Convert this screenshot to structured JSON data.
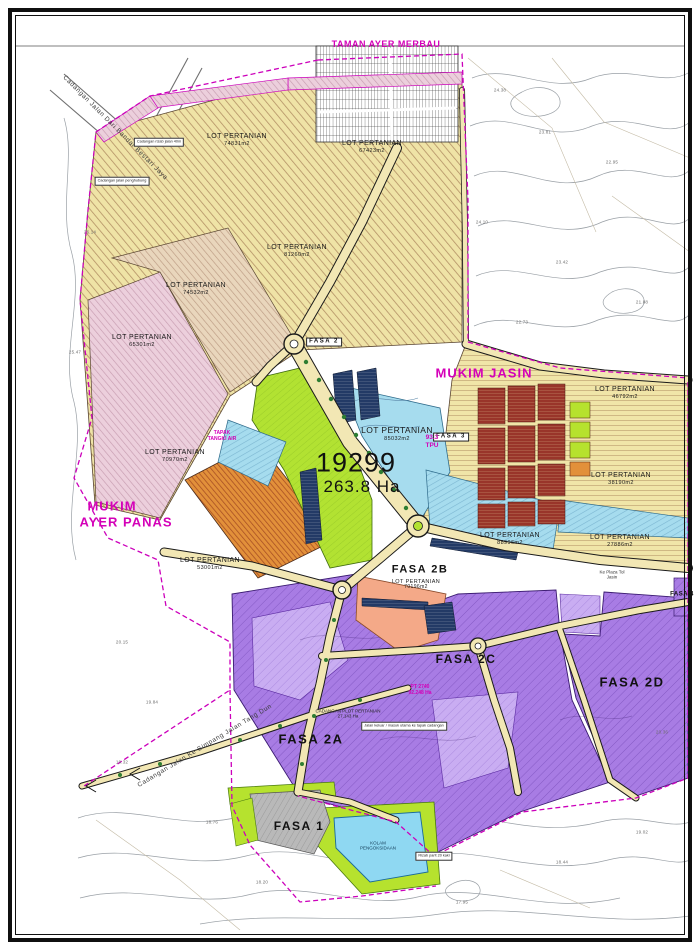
{
  "document": {
    "type": "site-layout-plan"
  },
  "region_labels": {
    "taman_ayer_merbau": "TAMAN AYER MERBAU",
    "mukim_jasin": "MUKIM JASIN",
    "mukim_line1": "MUKIM",
    "mukim_line2": "AYER PANAS"
  },
  "main_parcel": {
    "lot_no": "19299",
    "area": "263.8 Ha"
  },
  "lots": [
    {
      "name": "LOT PERTANIAN",
      "area": "74831m2"
    },
    {
      "name": "LOT PERTANIAN",
      "area": "67423m2"
    },
    {
      "name": "LOT PERTANIAN",
      "area": "81260m2"
    },
    {
      "name": "LOT PERTANIAN",
      "area": "74532m2"
    },
    {
      "name": "LOT PERTANIAN",
      "area": "65301m2"
    },
    {
      "name": "LOT PERTANIAN",
      "area": "70970m2"
    },
    {
      "name": "LOT PERTANIAN",
      "area": "53001m2"
    },
    {
      "name": "LOT PERTANIAN",
      "area": "85032m2"
    },
    {
      "name": "LOT PERTANIAN",
      "area": "88996m2"
    },
    {
      "name": "LOT PERTANIAN",
      "area": "46792m2"
    },
    {
      "name": "LOT PERTANIAN",
      "area": "38190m2"
    },
    {
      "name": "LOT PERTANIAN",
      "area": "27886m2"
    },
    {
      "name": "LOT PERTANIAN",
      "area": "70196m2"
    }
  ],
  "phases": {
    "fasa1": "FASA 1",
    "fasa2": "FASA 2",
    "fasa2a": "FASA 2A",
    "fasa2b": "FASA 2B",
    "fasa2c": "FASA 2C",
    "fasa2d": "FASA 2D",
    "fasa3": "FASA 3",
    "fasa4": "FASA 4"
  },
  "roads": {
    "north_west": "Cadangan Jalan Dari Bandar Bestari Jaya",
    "south_west": "Cadangan Jalan Ke Simpang Jalan Tang Dun",
    "toll_line1": "Ke Plaza Tol",
    "toll_line2": "Jasin"
  },
  "annotations": {
    "tank_line1": "TAPAK",
    "tank_line2": "TANGKI AIR",
    "tpu_line1": "93.3",
    "tpu_line2": "TPU",
    "pt_line1": "PT 2740",
    "pt_line2": "92.248 Ha",
    "plot_line1": "CADANGAN PLOT PERTANIAN",
    "plot_line2": "27.143 Ha",
    "pond_line1": "KOLAM",
    "pond_line2": "PENGOKSIDAAN",
    "box1": "Cadangan rizab jalan 40m",
    "box2": "Cadangan jalan penghubung",
    "box3": "Jalan keluar / masuk utama ke tapak cadangan",
    "box4": "Rizab parit 20 kaki"
  },
  "elevations": [
    "24.38",
    "23.81",
    "22.95",
    "24.10",
    "23.42",
    "21.88",
    "22.73",
    "20.15",
    "19.84",
    "19.32",
    "18.76",
    "18.20",
    "17.95",
    "18.44",
    "19.02",
    "20.36",
    "26.14",
    "25.47"
  ],
  "colors": {
    "boundary_magenta": "#cc00bb",
    "agri_yellow": "#efe3a6",
    "pink": "#eccfdc",
    "green": "#b2e232",
    "cyan": "#a6dcee",
    "pond_cyan": "#8fd8f2",
    "purple": "#a87ce4",
    "purple_light": "#c9adf2",
    "salmon": "#f4a988",
    "dark_red": "#99352a",
    "navy": "#233a66",
    "lime": "#b6e22e",
    "gray_zone": "#b9b9b9",
    "road_khaki": "#f2e7b4"
  }
}
